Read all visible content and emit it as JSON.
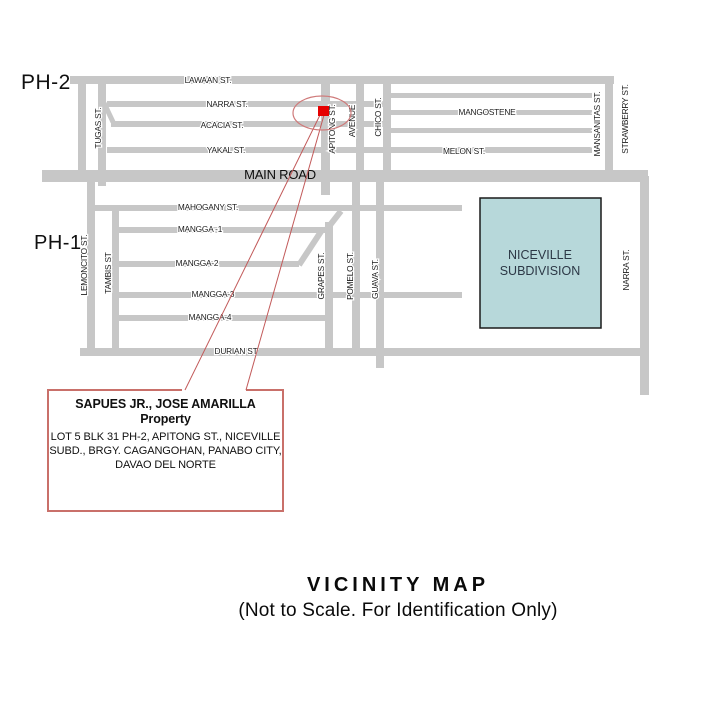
{
  "colors": {
    "road": "#c7c7c7",
    "street_label": "#1c1c1c",
    "main_road_label": "#0d0d0d",
    "leader_line": "#c25a5a",
    "marker_fill": "#e60000",
    "ellipse_stroke": "#cf7a7a",
    "callout_border": "#c9706a",
    "niceville_fill": "#b7d8da",
    "niceville_border": "#1a1a1a",
    "niceville_text": "#2c3846"
  },
  "area_labels": [
    {
      "id": "ph2",
      "text": "PH-2"
    },
    {
      "id": "ph1",
      "text": "PH-1"
    }
  ],
  "roads": [
    {
      "id": "lawaan",
      "x": 70,
      "y": 76,
      "w": 544,
      "h": 8
    },
    {
      "id": "narra-ph2",
      "x": 107,
      "y": 101,
      "w": 278,
      "h": 6
    },
    {
      "id": "acacia",
      "x": 111,
      "y": 121,
      "w": 274,
      "h": 6
    },
    {
      "id": "yakal-melon",
      "x": 107,
      "y": 147,
      "w": 485,
      "h": 6
    },
    {
      "id": "east-row-1",
      "x": 390,
      "y": 93,
      "w": 202,
      "h": 5
    },
    {
      "id": "mangostene",
      "x": 390,
      "y": 110,
      "w": 202,
      "h": 5
    },
    {
      "id": "east-row-3",
      "x": 390,
      "y": 128,
      "w": 202,
      "h": 5
    },
    {
      "id": "main-road",
      "x": 42,
      "y": 170,
      "w": 606,
      "h": 12
    },
    {
      "id": "mahogany",
      "x": 91,
      "y": 205,
      "w": 371,
      "h": 6
    },
    {
      "id": "mangga-1",
      "x": 115,
      "y": 227,
      "w": 210,
      "h": 6
    },
    {
      "id": "mangga-2",
      "x": 115,
      "y": 261,
      "w": 184,
      "h": 6
    },
    {
      "id": "mangga-3",
      "x": 115,
      "y": 292,
      "w": 347,
      "h": 6
    },
    {
      "id": "mangga-4",
      "x": 115,
      "y": 315,
      "w": 210,
      "h": 6
    },
    {
      "id": "durian",
      "x": 80,
      "y": 348,
      "w": 568,
      "h": 8
    },
    {
      "id": "west-vertical",
      "x": 78,
      "y": 76,
      "w": 8,
      "h": 100
    },
    {
      "id": "tugas",
      "x": 98,
      "y": 84,
      "w": 8,
      "h": 102
    },
    {
      "id": "apitong",
      "x": 321,
      "y": 84,
      "w": 9,
      "h": 111
    },
    {
      "id": "avenue",
      "x": 356,
      "y": 84,
      "w": 8,
      "h": 92
    },
    {
      "id": "chico",
      "x": 383,
      "y": 80,
      "w": 8,
      "h": 96
    },
    {
      "id": "mansanitas",
      "x": 605,
      "y": 80,
      "w": 8,
      "h": 96
    },
    {
      "id": "lemoncito",
      "x": 87,
      "y": 176,
      "w": 8,
      "h": 180
    },
    {
      "id": "tambis",
      "x": 112,
      "y": 205,
      "w": 7,
      "h": 147
    },
    {
      "id": "grapes",
      "x": 325,
      "y": 222,
      "w": 8,
      "h": 130
    },
    {
      "id": "pomelo",
      "x": 352,
      "y": 182,
      "w": 8,
      "h": 170
    },
    {
      "id": "guava",
      "x": 376,
      "y": 182,
      "w": 8,
      "h": 186
    },
    {
      "id": "narra-right",
      "x": 640,
      "y": 176,
      "w": 9,
      "h": 219
    }
  ],
  "diagonals": [
    {
      "id": "acacia-stub",
      "x1": 104,
      "y1": 103,
      "x2": 113,
      "y2": 122,
      "w": 5
    },
    {
      "id": "mahogany-grapes",
      "x1": 341,
      "y1": 211,
      "x2": 327,
      "y2": 229,
      "w": 6
    },
    {
      "id": "mangga-connector",
      "x1": 322,
      "y1": 230,
      "x2": 299,
      "y2": 265,
      "w": 6
    }
  ],
  "street_labels": [
    {
      "id": "lawaan-st",
      "text": "LAWAAN ST.",
      "x": 208,
      "y": 80,
      "vertical": false
    },
    {
      "id": "narra-st-ph2",
      "text": "NARRA ST.",
      "x": 227,
      "y": 104,
      "vertical": false
    },
    {
      "id": "acacia-st",
      "text": "ACACIA ST.",
      "x": 222,
      "y": 125,
      "vertical": false
    },
    {
      "id": "yakal-st",
      "text": "YAKAL ST.",
      "x": 226,
      "y": 150,
      "vertical": false
    },
    {
      "id": "mangostene",
      "text": "MANGOSTENE",
      "x": 487,
      "y": 112,
      "vertical": false
    },
    {
      "id": "melon-st",
      "text": "MELON ST.",
      "x": 464,
      "y": 151,
      "vertical": false
    },
    {
      "id": "main-road",
      "text": "MAIN ROAD",
      "x": 280,
      "y": 176,
      "vertical": false,
      "size": 13,
      "main": true
    },
    {
      "id": "mahogany-st",
      "text": "MAHOGANY ST.",
      "x": 208,
      "y": 207,
      "vertical": false
    },
    {
      "id": "mangga-1",
      "text": "MANGGA -1",
      "x": 200,
      "y": 229,
      "vertical": false
    },
    {
      "id": "mangga-2",
      "text": "MANGGA-2",
      "x": 197,
      "y": 263,
      "vertical": false
    },
    {
      "id": "mangga-3",
      "text": "MANGGA-3",
      "x": 213,
      "y": 294,
      "vertical": false
    },
    {
      "id": "mangga-4",
      "text": "MANGGA-4",
      "x": 210,
      "y": 317,
      "vertical": false
    },
    {
      "id": "durian-st",
      "text": "DURIAN ST",
      "x": 236,
      "y": 351,
      "vertical": false
    },
    {
      "id": "tugas-st",
      "text": "TUGAS ST.",
      "x": 98,
      "y": 128,
      "vertical": true
    },
    {
      "id": "apitong-st",
      "text": "APITONG ST.",
      "x": 332,
      "y": 129,
      "vertical": true
    },
    {
      "id": "avenue",
      "text": "AVENUE",
      "x": 352,
      "y": 121,
      "vertical": true
    },
    {
      "id": "chico-st",
      "text": "CHICO ST.",
      "x": 378,
      "y": 117,
      "vertical": true
    },
    {
      "id": "mansanitas-st",
      "text": "MANSANITAS ST.",
      "x": 597,
      "y": 124,
      "vertical": true
    },
    {
      "id": "strawberry-st",
      "text": "STRAWBERRY ST.",
      "x": 625,
      "y": 119,
      "vertical": true
    },
    {
      "id": "lemoncito-st",
      "text": "LEMONCITO ST.",
      "x": 84,
      "y": 265,
      "vertical": true
    },
    {
      "id": "tambis-st",
      "text": "TAMBIS ST",
      "x": 108,
      "y": 273,
      "vertical": true
    },
    {
      "id": "grapes-st",
      "text": "GRAPES ST.",
      "x": 321,
      "y": 276,
      "vertical": true
    },
    {
      "id": "pomelo-st",
      "text": "POMELO ST.",
      "x": 350,
      "y": 276,
      "vertical": true
    },
    {
      "id": "guava-st",
      "text": "GUAVA ST.",
      "x": 375,
      "y": 279,
      "vertical": true
    },
    {
      "id": "narra-st-right",
      "text": "NARRA ST.",
      "x": 626,
      "y": 270,
      "vertical": true
    }
  ],
  "niceville": {
    "x": 480,
    "y": 198,
    "w": 121,
    "h": 130,
    "lines": [
      "NICEVILLE",
      "SUBDIVISION"
    ],
    "text_x": 540,
    "text_y1": 259,
    "text_y2": 275,
    "font_size": 12.5
  },
  "marker": {
    "ellipse": {
      "cx": 322,
      "cy": 113,
      "rx": 29,
      "ry": 17
    },
    "square": {
      "x": 318,
      "y": 106,
      "w": 11,
      "h": 10
    },
    "leaders": [
      {
        "x1": 320,
        "y1": 115,
        "x2": 185,
        "y2": 390
      },
      {
        "x1": 324,
        "y1": 115,
        "x2": 246,
        "y2": 390
      }
    ]
  },
  "callout": {
    "x": 48,
    "y": 390,
    "w": 235,
    "h": 121,
    "gap_x1": 182,
    "gap_x2": 246,
    "owner": "SAPUES JR., JOSE AMARILLA",
    "property_word": "Property",
    "address_lines": [
      "LOT 5 BLK 31 PH-2, APITONG ST., NICEVILLE",
      "SUBD., BRGY. CAGANGOHAN, PANABO CITY,",
      "DAVAO DEL NORTE"
    ]
  },
  "title": {
    "main": "VICINITY MAP",
    "subtitle": "(Not to Scale. For Identification Only)"
  }
}
